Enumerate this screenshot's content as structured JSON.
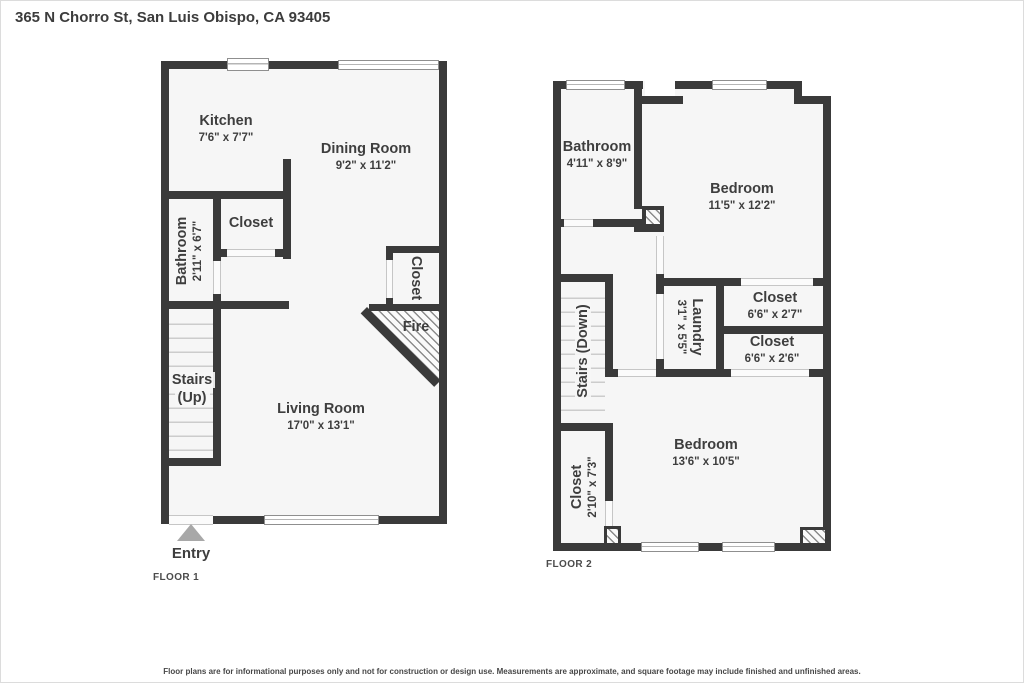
{
  "title": "365 N Chorro St, San Luis Obispo, CA 93405",
  "disclaimer": "Floor plans are for informational purposes only and not for construction or design use. Measurements are approximate, and square footage may include finished and unfinished areas.",
  "floor1": {
    "label": "FLOOR 1",
    "entry": "Entry",
    "kitchen_name": "Kitchen",
    "kitchen_dims": "7'6\" x 7'7\"",
    "dining_name": "Dining Room",
    "dining_dims": "9'2\" x 11'2\"",
    "bathroom_name": "Bathroom",
    "bathroom_dims": "2'11\" x 6'7\"",
    "closet_name": "Closet",
    "closet_right_name": "Closet",
    "stairs_line1": "Stairs",
    "stairs_line2": "(Up)",
    "fireplace_name": "Fire",
    "living_name": "Living Room",
    "living_dims": "17'0\" x 13'1\""
  },
  "floor2": {
    "label": "FLOOR 2",
    "bathroom_name": "Bathroom",
    "bathroom_dims": "4'11\" x 8'9\"",
    "bedroom1_name": "Bedroom",
    "bedroom1_dims": "11'5\" x 12'2\"",
    "closet1_name": "Closet",
    "closet1_dims": "6'6\" x 2'7\"",
    "closet2_name": "Closet",
    "closet2_dims": "6'6\" x 2'6\"",
    "laundry_name": "Laundry",
    "laundry_dims": "3'1\" x 5'5\"",
    "stairs_name": "Stairs (Down)",
    "closet3_name": "Closet",
    "closet3_dims": "2'10\" x 7'3\"",
    "bedroom2_name": "Bedroom",
    "bedroom2_dims": "13'6\" x 10'5\""
  },
  "colors": {
    "wall": "#3a3a3a",
    "floor": "#f6f6f6",
    "text": "#3e3e3e",
    "entry_arrow": "#a8a8a8"
  }
}
